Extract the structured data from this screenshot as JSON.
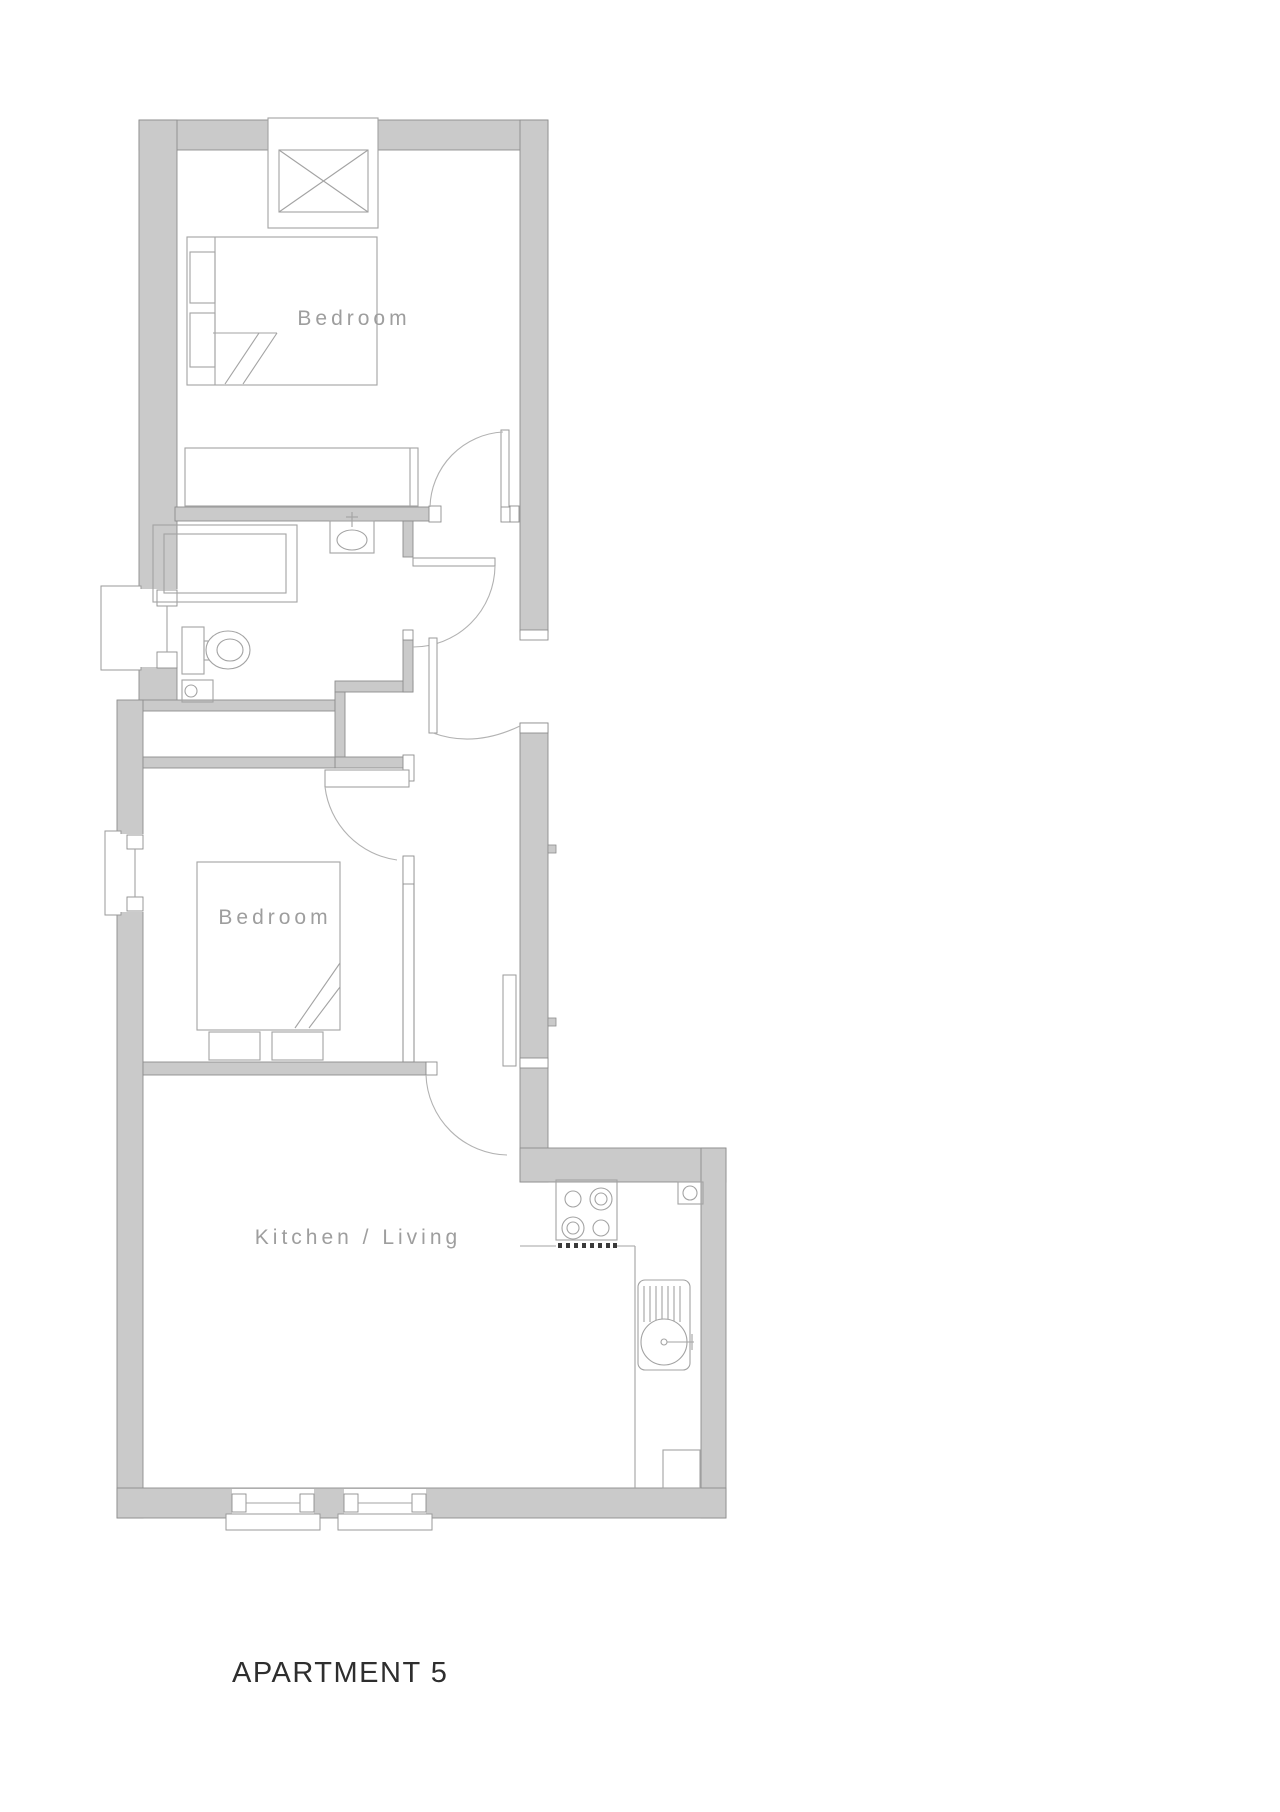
{
  "plan": {
    "title": "APARTMENT 5",
    "rooms": [
      {
        "id": "bedroom-1",
        "label": "Bedroom",
        "fixtures": [
          "double-bed-icon",
          "wardrobe-icon",
          "chimney-flue-icon"
        ]
      },
      {
        "id": "bathroom",
        "label": "",
        "fixtures": [
          "shower-icon",
          "basin-icon",
          "toilet-icon",
          "window-icon"
        ]
      },
      {
        "id": "bedroom-2",
        "label": "Bedroom",
        "fixtures": [
          "double-bed-icon",
          "window-icon"
        ]
      },
      {
        "id": "kitchen-living",
        "label": "Kitchen / Living",
        "fixtures": [
          "hob-icon",
          "sink-drainer-icon",
          "appliance-icon",
          "window-icon",
          "window-icon"
        ]
      }
    ]
  },
  "colors": {
    "wall_fill": "#cacaca",
    "wall_stroke": "#8d8d8d",
    "furniture_line": "#a3a3a3",
    "door_arc": "#b2b2b2",
    "room_label": "#9e9e9e",
    "title_text": "#2e2e2e",
    "background": "#ffffff"
  }
}
